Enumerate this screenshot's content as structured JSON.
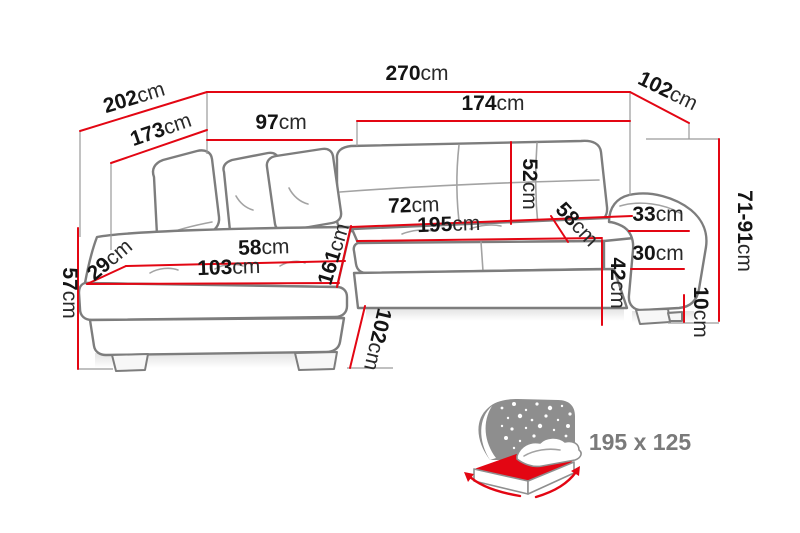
{
  "diagram_title": "corner-sofa-dimensions",
  "dims": {
    "d270": {
      "num": "270",
      "unit": "cm"
    },
    "d202": {
      "num": "202",
      "unit": "cm"
    },
    "d173": {
      "num": "173",
      "unit": "cm"
    },
    "d97": {
      "num": "97",
      "unit": "cm"
    },
    "d174": {
      "num": "174",
      "unit": "cm"
    },
    "d102tr": {
      "num": "102",
      "unit": "cm"
    },
    "d7191": {
      "num": "71-91",
      "unit": "cm"
    },
    "d52": {
      "num": "52",
      "unit": "cm"
    },
    "d72": {
      "num": "72",
      "unit": "cm"
    },
    "d195": {
      "num": "195",
      "unit": "cm"
    },
    "d58r": {
      "num": "58",
      "unit": "cm"
    },
    "d33": {
      "num": "33",
      "unit": "cm"
    },
    "d30": {
      "num": "30",
      "unit": "cm"
    },
    "d42": {
      "num": "42",
      "unit": "cm"
    },
    "d10": {
      "num": "10",
      "unit": "cm"
    },
    "d57": {
      "num": "57",
      "unit": "cm"
    },
    "d29": {
      "num": "29",
      "unit": "cm"
    },
    "d58l": {
      "num": "58",
      "unit": "cm"
    },
    "d103": {
      "num": "103",
      "unit": "cm"
    },
    "d161": {
      "num": "161",
      "unit": "cm"
    },
    "d102b": {
      "num": "102",
      "unit": "cm"
    }
  },
  "bed_icon": {
    "size_label": "195 x 125"
  },
  "colors": {
    "dimension_line": "#e30613",
    "sofa_outline": "#7d7d7d",
    "label_text": "#141414",
    "icon_gray": "#8e8e8e",
    "icon_text": "#7a7a7a",
    "background": "#ffffff"
  }
}
